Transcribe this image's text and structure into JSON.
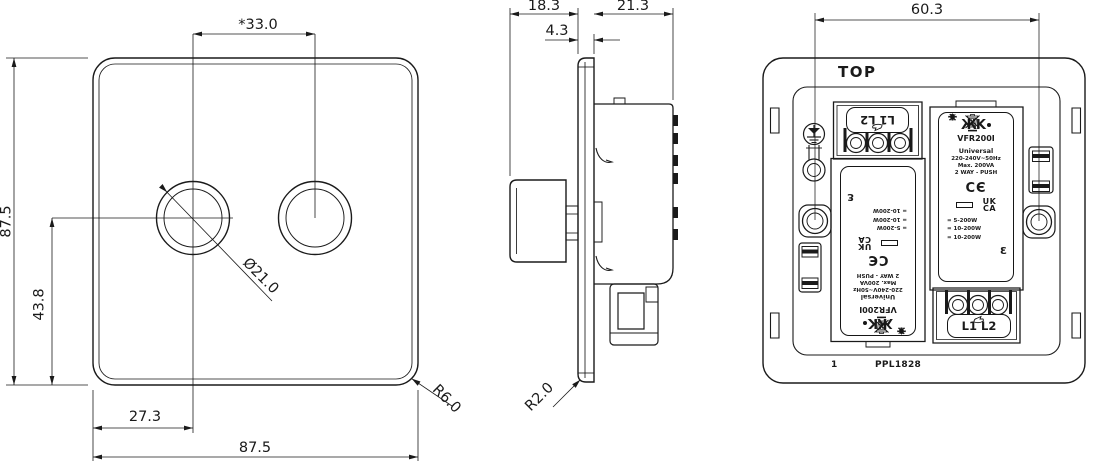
{
  "drawing": {
    "title": "Two-gang dimmer switch engineering drawing",
    "colors": {
      "line": "#1a1a1a",
      "background": "#ffffff"
    },
    "front": {
      "dim_height": "87.5",
      "dim_width": "87.5",
      "dim_knob_spacing": "*33.0",
      "dim_knob_center_height": "43.8",
      "dim_knob_offset": "27.3",
      "dim_knob_diameter": "Ø21.0",
      "dim_corner_radius": "R6.0"
    },
    "side": {
      "dim_knob_depth": "18.3",
      "dim_plate_thickness": "4.3",
      "dim_body_depth": "21.3",
      "dim_corner_radius": "R2.0"
    },
    "back": {
      "dim_screw_spacing": "60.3",
      "orientation_label": "TOP",
      "footer_index": "1",
      "footer_code": "PPL1828",
      "terminal_label": "L1 L2",
      "module_label": {
        "logo": "ЖK",
        "model": "VFR200I",
        "range": "Universal",
        "voltage": "220-240V~50Hz",
        "max_load": "Max. 200VA",
        "switching": "2 WAY - PUSH",
        "ce": "CЄ",
        "ukca_line1": "UK",
        "ukca_line2": "CA",
        "side_mark": "Ɛ",
        "loads": [
          {
            "icon": "led-lamp-icon",
            "text": "= 5-200W"
          },
          {
            "icon": "incandescent-lamp-icon",
            "text": "= 10-200W"
          },
          {
            "icon": "halogen-lamp-icon",
            "text": "= 10-200W"
          }
        ]
      }
    }
  }
}
